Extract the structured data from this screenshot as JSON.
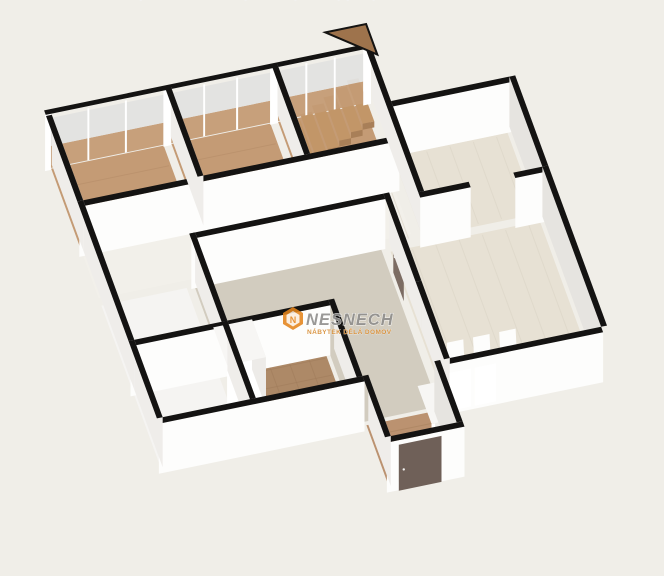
{
  "scene": {
    "type": "3d-floorplan-render",
    "background": "#f0eee8",
    "palette": {
      "wall_cap": "#141312",
      "wall_face_bright": "#fdfdfc",
      "wall_face_light": "#efedea",
      "wall_face_shade": "#e6e4e0",
      "door": "#7c6c63",
      "door_dark": "#6f6058",
      "glass_upper": "#e2e2e0",
      "window_frame": "#ffffff",
      "wood": "#c49b75",
      "wood_entrance": "#bb9270",
      "brown_tile": "#ad8967",
      "light_tile": "#e7e1d4",
      "white_floor": "#f5f4f2",
      "beige_floor": "#d2ccbf",
      "corridor_floor": "#f2f0ea",
      "stair_wood": "#c29668",
      "stair_upper": "#9e734c",
      "fixture_white": "#ffffff",
      "sunlight": "#ffffff"
    },
    "rooms": [
      {
        "id": "bedroom-left",
        "floor_material": "wood"
      },
      {
        "id": "bedroom-middle",
        "floor_material": "wood"
      },
      {
        "id": "stairwell",
        "floor_material": "wood"
      },
      {
        "id": "corridor",
        "floor_material": "corridor_floor"
      },
      {
        "id": "west-room",
        "floor_material": "white_floor"
      },
      {
        "id": "west-wc",
        "floor_material": "white_floor"
      },
      {
        "id": "bathroom",
        "floor_material": "brown_tile"
      },
      {
        "id": "center-hall",
        "floor_material": "beige_floor"
      },
      {
        "id": "entrance-hall",
        "floor_material": "wood_entrance"
      },
      {
        "id": "kitchen",
        "floor_material": "light_tile"
      },
      {
        "id": "living-room",
        "floor_material": "light_tile"
      }
    ],
    "fixtures": [
      "staircase",
      "toilet",
      "bidet",
      "shower-enclosure",
      "wardrobe",
      "entrance-door",
      "interior-doors",
      "window-walls",
      "floor-sunlight-patches"
    ]
  },
  "watermark": {
    "brand": "NESNECH",
    "tagline": "NÁBYTEK DĚLÁ DOMOV",
    "brand_color": "#8d8c8a",
    "tagline_color": "#d6892e",
    "hex_color": "#e5851c",
    "hex_letter": "N"
  }
}
